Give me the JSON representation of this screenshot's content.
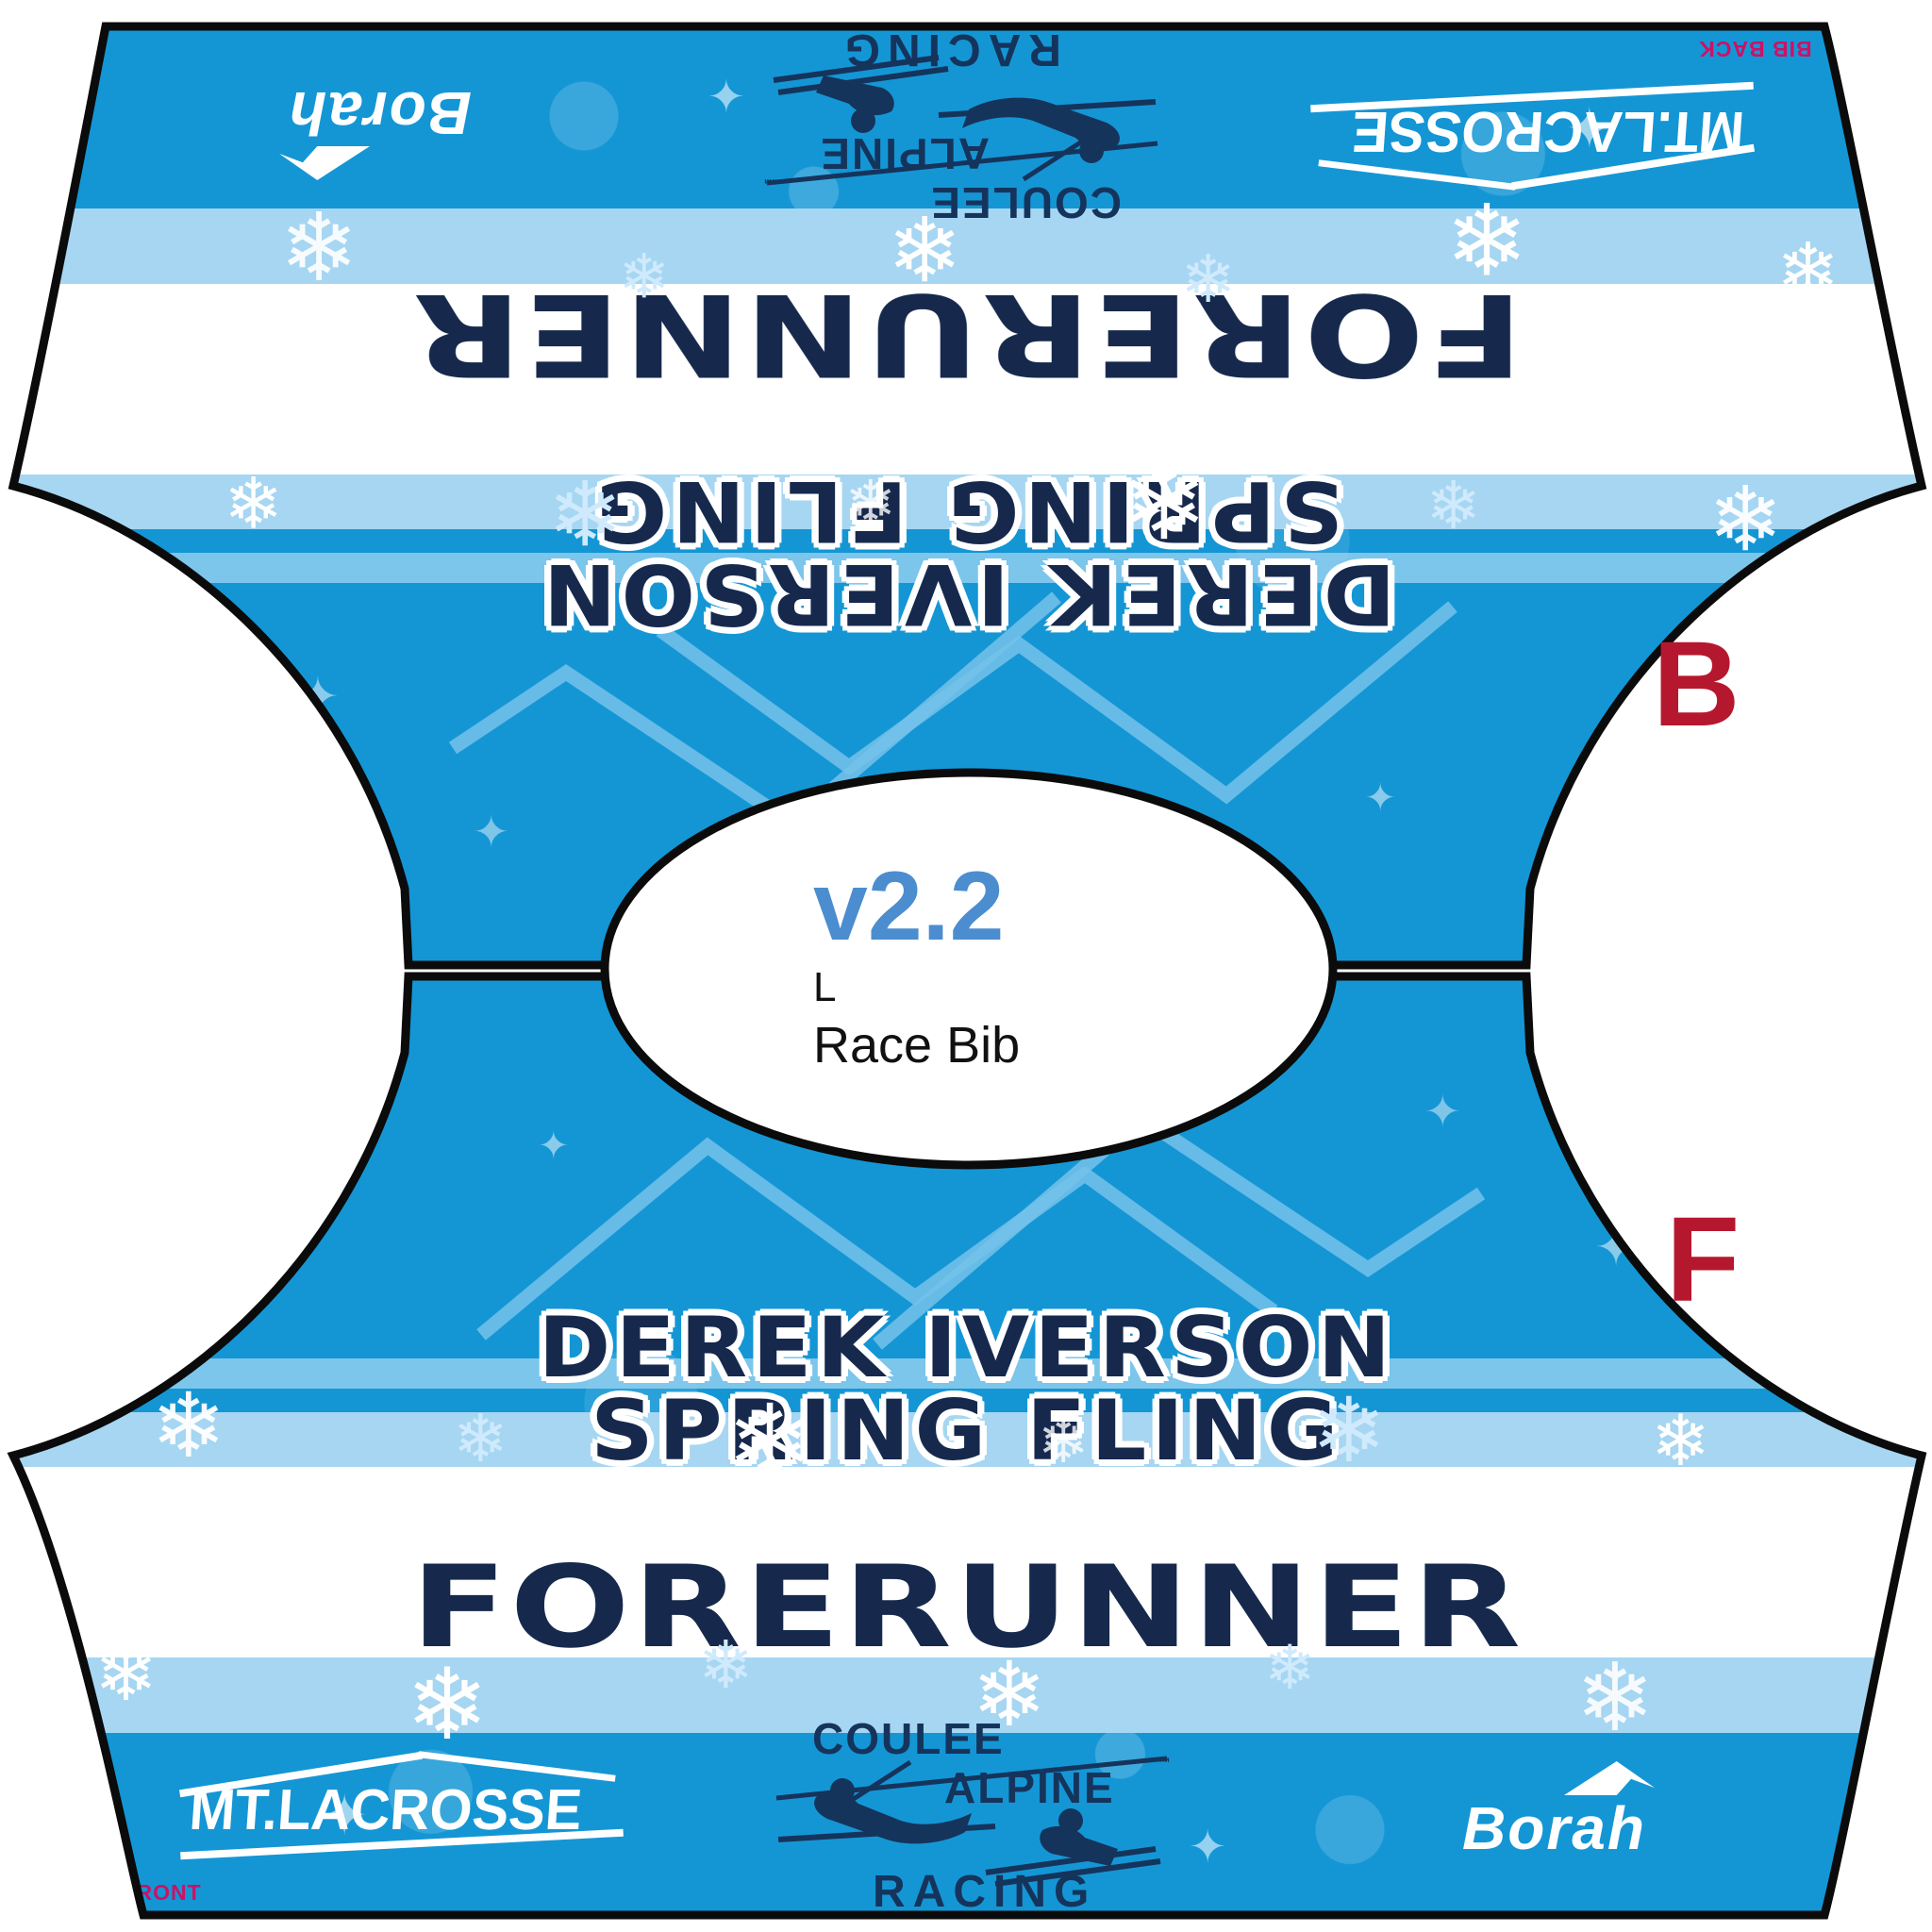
{
  "bib": {
    "team_name": "FORERUNNER",
    "event_line1": "DEREK IVERSON",
    "event_line2": "SPRING FLING",
    "version": "v2.2",
    "size": "L",
    "product": "Race Bib",
    "marker_back": "B",
    "marker_front": "F",
    "corner_label_back": "L  BIB BACK",
    "corner_label_front": "L  FRONT",
    "logos": {
      "borah": "Borah",
      "mt_lacrosse": "MT.LACROSSE",
      "coulee_line1": "COULEE",
      "coulee_line2": "ALPINE",
      "coulee_line3": "RACING",
      "trademark": "™"
    },
    "colors": {
      "main_blue": "#1496d5",
      "light_blue": "#a6d6f2",
      "navy": "#16294d",
      "version_blue": "#4c8dcf",
      "marker_red": "#b5182e",
      "corner_magenta": "#cc1166",
      "outline_black": "#0b0b0b"
    },
    "decor": {
      "snowflake": "❄",
      "sparkle": "✦"
    }
  }
}
